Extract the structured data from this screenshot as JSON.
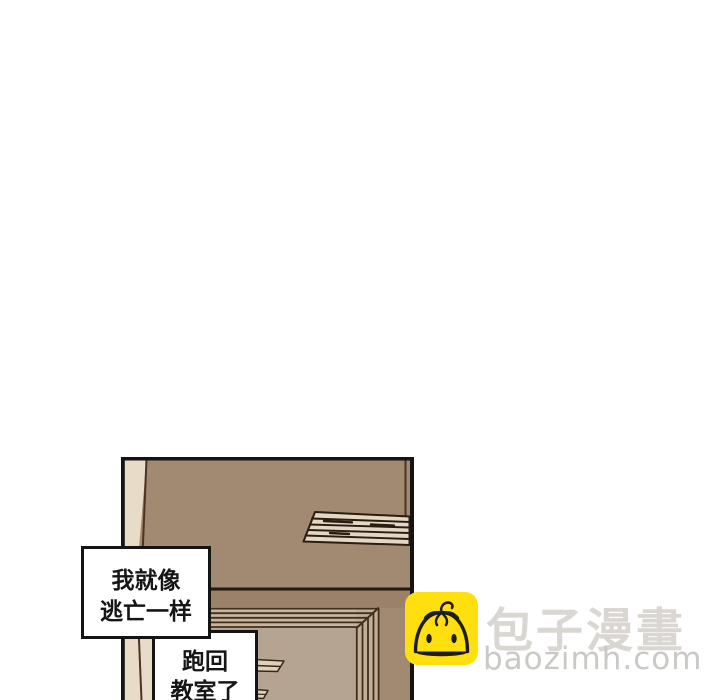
{
  "page": {
    "type": "webtoon-comic-strip-segment",
    "background_color": "#ffffff"
  },
  "panel": {
    "description": "comic panel of a classroom door and brown wall",
    "border_color": "#141414",
    "wall_color": "#a28972",
    "wall_shadow_color": "#9b8167",
    "door_color": "#b5a492",
    "frame_light_color": "#e8dbc8",
    "molding_color": "#c7b59e",
    "vent_color": "#e4d7c3",
    "line_color": "#3a281a"
  },
  "bubbles": {
    "bubble1": {
      "lines": [
        "我就像",
        "逃亡一样"
      ]
    },
    "bubble2": {
      "lines": [
        "跑回",
        "教室了"
      ]
    }
  },
  "watermark": {
    "site_name_cn": "包子漫畫",
    "site_domain": "baozimh.com",
    "logo_icon": "baozi-bun-face",
    "logo_background": "#ffdf0e",
    "logo_outline": "#1d1d1b",
    "text_color_cn": "#dad7d2",
    "text_color_domain": "#cbc9c5"
  }
}
